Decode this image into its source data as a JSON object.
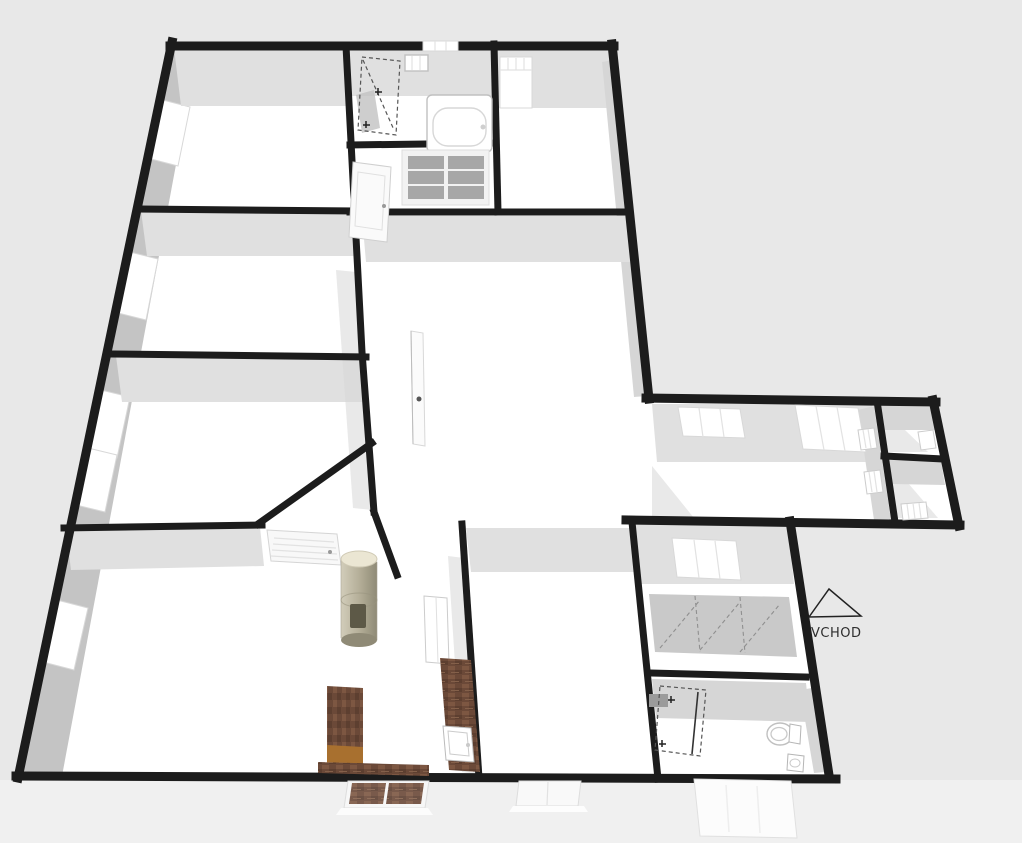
{
  "view": {
    "width": 1022,
    "height": 843,
    "type": "3d-floor-plan-render"
  },
  "labels": {
    "entrance": "VCHOD"
  },
  "colors": {
    "background": "#e8e8e8",
    "apron": "#f0f0f0",
    "wall": "#1c1c1c",
    "floor": "#ffffff",
    "wall_face": "#e0e0e0",
    "wall_face_dark": "#d6d6d6",
    "exterior_wall_band": "#c4c4c4",
    "glass_dash": "#555555",
    "fixture_outline": "#c0c0c0",
    "wood_dark": "#6b4938",
    "wood_mid": "#7d5742",
    "wood_front": "#a8702f",
    "stove_top": "#ebe6d3",
    "stove_body": "#b5af99",
    "wardrobe": "#c9c9c9"
  },
  "objects": [
    "bathtub",
    "shower-enclosure",
    "wall-cabinet",
    "paned-window",
    "interior-door",
    "open-door",
    "louver-door",
    "wood-stove",
    "kitchen-counter",
    "kitchen-sink",
    "refrigerator",
    "sideboard",
    "tv-bench",
    "wardrobe-row",
    "shower-enclosure-2",
    "toilet",
    "bathroom-sink",
    "radiator",
    "window",
    "entrance-arrow"
  ]
}
